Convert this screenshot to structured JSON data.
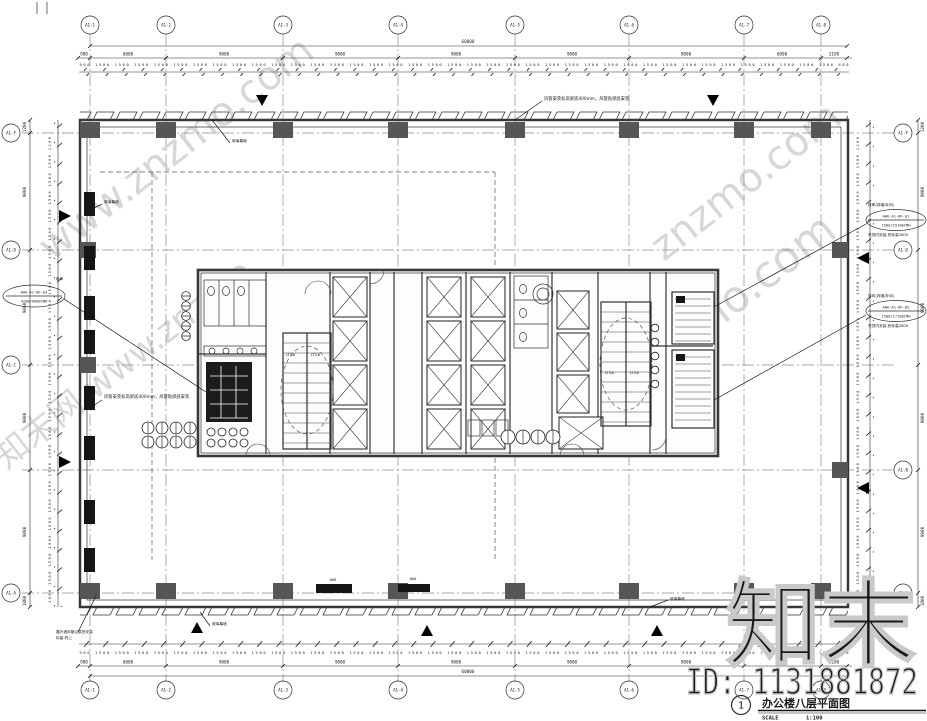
{
  "title_block": {
    "number": "1",
    "title": "办公楼八层平面图",
    "scale_label": "SCALE",
    "scale_value": "1:100"
  },
  "watermark": {
    "site": "www.znzmo.com",
    "brand_site": "知末网 www.znzmo",
    "site_short": "znzmo.com",
    "big": "知末",
    "id": "ID: 1131881872"
  },
  "grid": {
    "top_labels": [
      "A1-1",
      "A1-2",
      "A1-3",
      "A1-4",
      "A1-5",
      "A1-6",
      "A1-7",
      "A1-8"
    ],
    "left_labels": [
      "A1-F",
      "A1-D",
      "A1-C",
      "A1-A"
    ],
    "right_labels": [
      "A1-F",
      "A1-D",
      "A1-B",
      "A1-A"
    ]
  },
  "dims": {
    "top_overall": "60000",
    "bottom_overall": "60000",
    "bays": [
      "900",
      "6000",
      "9000",
      "9000",
      "9000",
      "9000",
      "9000",
      "6000",
      "2100"
    ],
    "h_modules": "900 1500 1500 1500 1500 1500 1500 1500 1500 1500 1500 1500 1500 1500 1500 1500 1500 1500 1500 1500 1500 1500 1500 1500 1500 1500 1500 1500 1500 1500 1500 1500 1500 1500 1500 1500 1500 1500 1500 600",
    "v_modules": "1800 1500 1500 1500 1500 1500 1500 1500 1500 1500 1500 1500 1500 1500 1500 1500 1500 1500 1500 1500 1500 1500 1500 1500 1500 1200",
    "v_bays": [
      "1200",
      "9000",
      "9000",
      "9000",
      "9000",
      "1800"
    ]
  },
  "annotations": {
    "duct_note": "风管安装标高梁底400mm，风管贴梁底安装",
    "curtain_tag": "玻璃幕墙",
    "note_bl_1": "靠外墙风管沿梁底安装",
    "note_bl_2": "标高:同上",
    "duct_size": "006",
    "fresh_header": "新风",
    "exhaust_header": "排风(排烟/补风)",
    "ahu_note": "吊顶内安装 底标高2600",
    "ahu_left_name": "AHU-A1-8F-03",
    "ahu_left_flow": "4200/9000CMH",
    "ahu_r1_name": "AHU-A1-8F-01",
    "ahu_r1_flow": "1500/15100CMH",
    "ahu_r2_name": "AHU-A1-8F-02",
    "ahu_r2_flow": "1500/17100CMH"
  },
  "core": {
    "stair_a": "LT3#",
    "stair_b": "LT2#"
  }
}
